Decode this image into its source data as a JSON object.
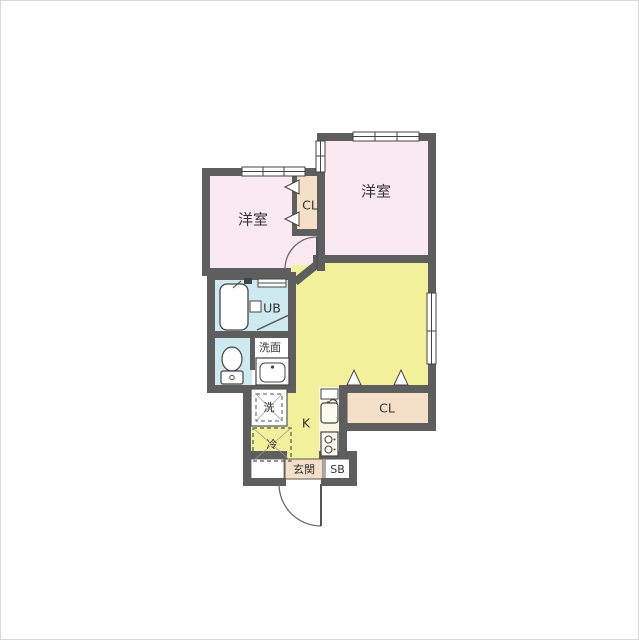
{
  "plan": {
    "rooms": {
      "bedroom1": {
        "label": "洋室"
      },
      "bedroom2": {
        "label": "洋室"
      },
      "closet_upper": {
        "label": "CL"
      },
      "closet_lower": {
        "label": "CL"
      },
      "unit_bath": {
        "label": "UB"
      },
      "washroom": {
        "label": "洗面"
      },
      "washer": {
        "label": "洗"
      },
      "fridge": {
        "label": "冷"
      },
      "kitchen": {
        "label": "K"
      },
      "entrance": {
        "label": "玄関"
      },
      "shoe_box": {
        "label": "SB"
      }
    },
    "colors": {
      "wall": "#5f5e5e",
      "room_pink": "#fbe9f1",
      "room_yellow": "#f2f09b",
      "closet_peach": "#f6dfc8",
      "bath_blue": "#cfe9f1",
      "counter_cream": "#f9f7e2",
      "white": "#ffffff",
      "line_dark": "#444444",
      "text": "#333333"
    }
  }
}
